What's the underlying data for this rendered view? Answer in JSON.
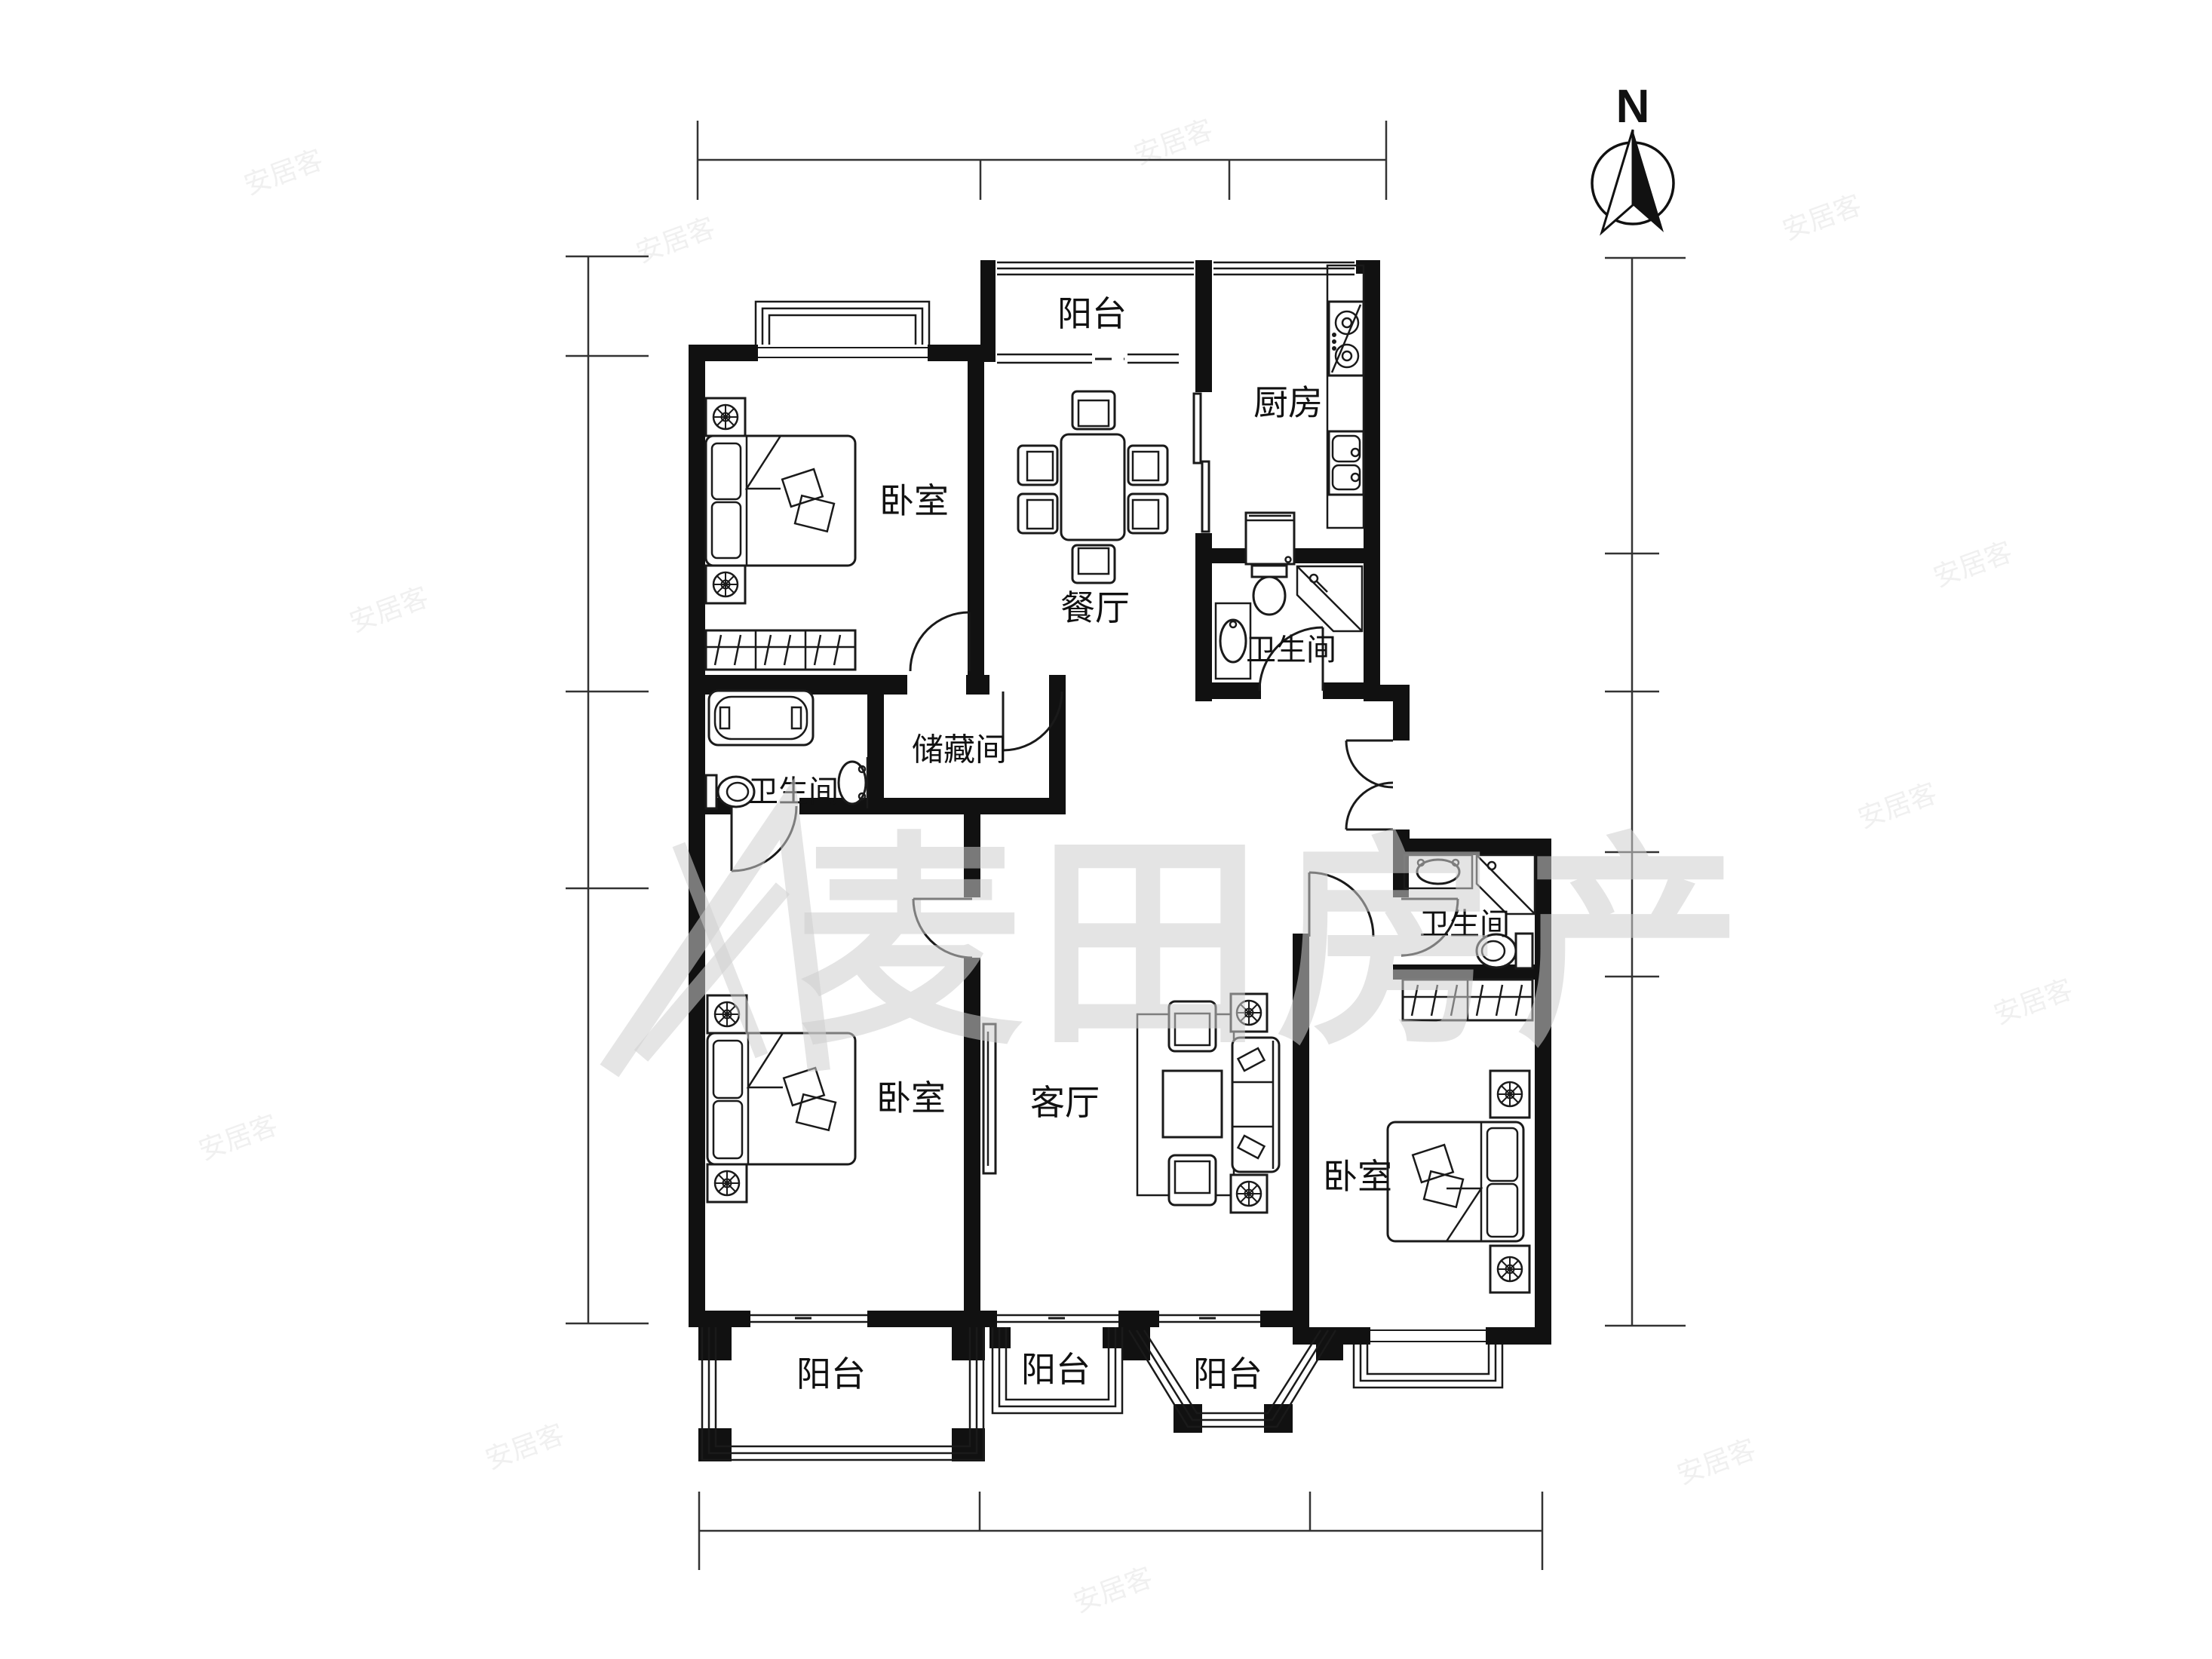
{
  "meta": {
    "type": "real-estate floor plan drawing",
    "background": "#ffffff"
  },
  "colors": {
    "wall": "#111111",
    "line": "#1a1a1a",
    "text": "#111111",
    "watermark": "#cfcfcf",
    "background": "#ffffff"
  },
  "compass": {
    "label": "N"
  },
  "watermark": {
    "brand": "麦田房产",
    "site": "安居客"
  },
  "rooms": [
    {
      "id": "balcony-north",
      "label": "阳台"
    },
    {
      "id": "kitchen",
      "label": "厨房"
    },
    {
      "id": "bedroom-northwest",
      "label": "卧室"
    },
    {
      "id": "dining-room",
      "label": "餐厅"
    },
    {
      "id": "bathroom-north",
      "label": "卫生间"
    },
    {
      "id": "storage-room",
      "label": "储藏间"
    },
    {
      "id": "bathroom-west",
      "label": "卫生间"
    },
    {
      "id": "bathroom-east",
      "label": "卫生间"
    },
    {
      "id": "bedroom-southwest",
      "label": "卧室"
    },
    {
      "id": "living-room",
      "label": "客厅"
    },
    {
      "id": "bedroom-southeast",
      "label": "卧室"
    },
    {
      "id": "balcony-southwest",
      "label": "阳台"
    },
    {
      "id": "balcony-south",
      "label": "阳台"
    },
    {
      "id": "balcony-southeast",
      "label": "阳台"
    }
  ],
  "icons": [
    "north-arrow-icon",
    "double-bed-icon",
    "nightstand-lamp-icon",
    "wardrobe-hangers-icon",
    "dining-table-icon",
    "dining-chair-icon",
    "gas-stove-icon",
    "kitchen-sink-icon",
    "washing-machine-icon",
    "toilet-icon",
    "bathtub-icon",
    "wash-basin-icon",
    "shower-corner-icon",
    "sofa-icon",
    "armchair-icon",
    "coffee-table-icon",
    "side-table-lamp-icon",
    "tv-icon",
    "area-rug-icon",
    "door-swing-icon",
    "window-icon",
    "balcony-railing-icon",
    "bay-window-icon"
  ]
}
